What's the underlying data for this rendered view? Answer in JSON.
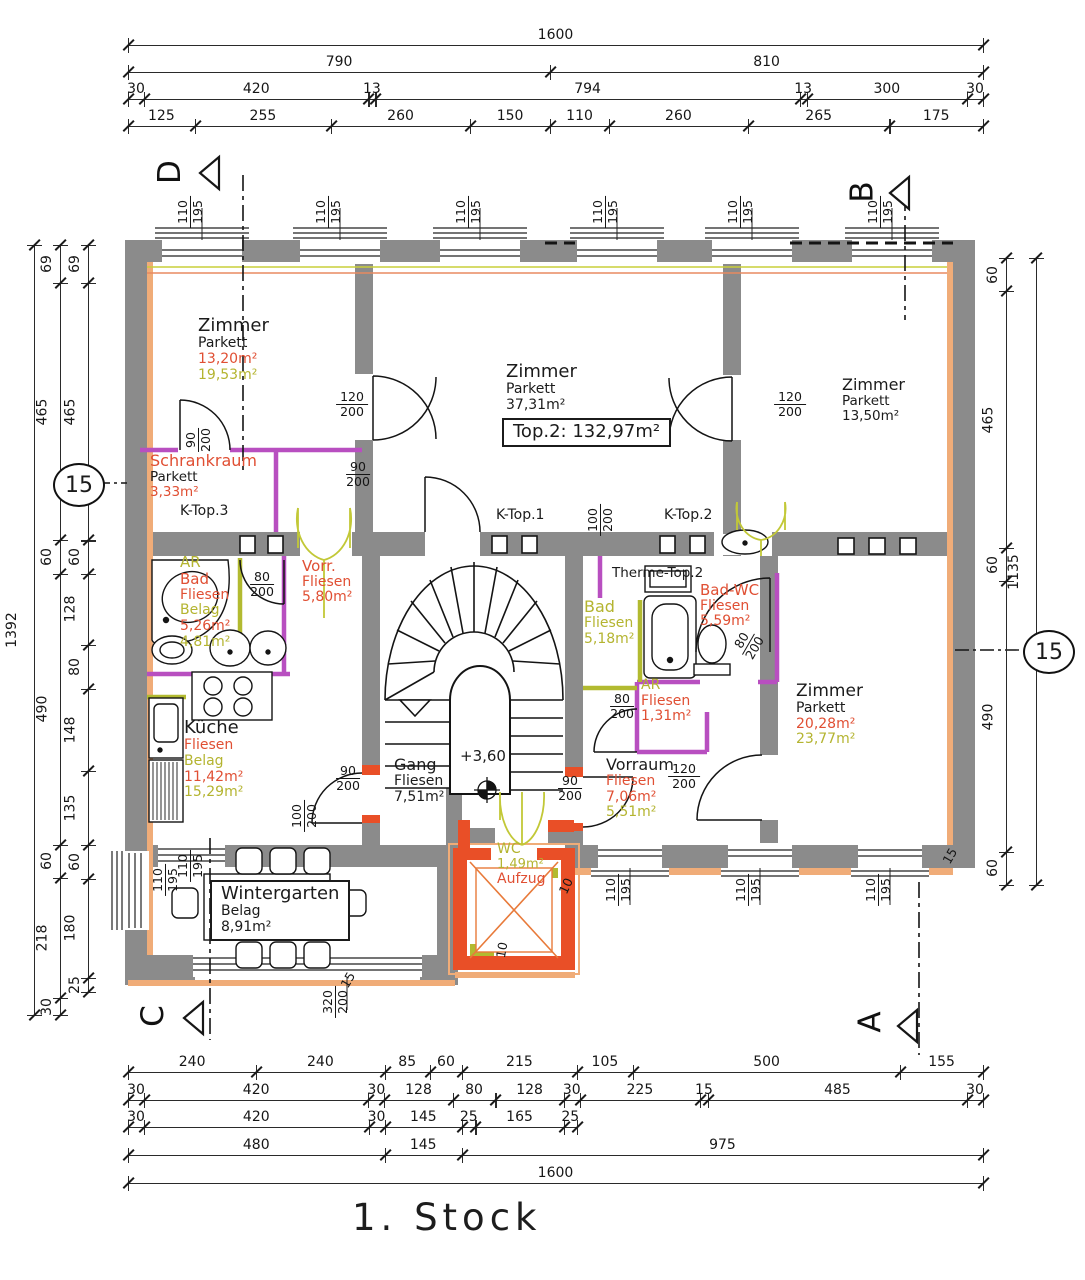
{
  "title": "1. Stock",
  "colors": {
    "k": "#1b1b1b",
    "r": "#e04f33",
    "y": "#b4b430",
    "wall": "#8b8b8b",
    "newwall": "#e94f27",
    "orange": "#f0ac78",
    "purple": "#b84fc0",
    "olive": "#b2ba30"
  },
  "rooms": [
    {
      "id": "zimmer-tl",
      "x": 198,
      "y": 316,
      "lines": [
        [
          "Zimmer",
          "k",
          18
        ],
        [
          "Parkett",
          "k",
          14
        ],
        [
          "13,20m²",
          "r",
          14
        ],
        [
          "19,53m²",
          "y",
          14
        ]
      ]
    },
    {
      "id": "schrankraum",
      "x": 150,
      "y": 452,
      "lines": [
        [
          "Schrankraum",
          "r",
          16
        ],
        [
          "Parkett",
          "k",
          13.5
        ],
        [
          "3,33m²",
          "r",
          13.5
        ]
      ]
    },
    {
      "id": "k-top-3",
      "x": 180,
      "y": 504,
      "lines": [
        [
          "K-Top.3",
          "k",
          14
        ]
      ]
    },
    {
      "id": "zimmer-mitte",
      "x": 506,
      "y": 362,
      "lines": [
        [
          "Zimmer",
          "k",
          18
        ],
        [
          "Parkett",
          "k",
          14
        ],
        [
          "37,31m²",
          "k",
          14
        ]
      ]
    },
    {
      "id": "top2-total",
      "x": 502,
      "y": 418,
      "box": true,
      "lines": [
        [
          "Top.2:  132,97m²",
          "k",
          18
        ]
      ]
    },
    {
      "id": "zimmer-tr",
      "x": 842,
      "y": 376,
      "lines": [
        [
          "Zimmer",
          "k",
          16
        ],
        [
          "Parkett",
          "k",
          13.5
        ],
        [
          "13,50m²",
          "k",
          13.5
        ]
      ]
    },
    {
      "id": "ar-bad",
      "x": 180,
      "y": 554,
      "lines": [
        [
          "AR",
          "y",
          15
        ],
        [
          "Bad",
          "r",
          15
        ],
        [
          "Fliesen",
          "r",
          14
        ],
        [
          "Belag",
          "y",
          14
        ],
        [
          "5,26m²",
          "r",
          14
        ],
        [
          "4,81m²",
          "y",
          14
        ]
      ]
    },
    {
      "id": "vorr",
      "x": 302,
      "y": 558,
      "lines": [
        [
          "Vorr.",
          "r",
          15
        ],
        [
          "Fliesen",
          "r",
          14
        ],
        [
          "5,80m²",
          "r",
          14
        ]
      ]
    },
    {
      "id": "kueche",
      "x": 184,
      "y": 718,
      "lines": [
        [
          "Küche",
          "k",
          18
        ],
        [
          "Fliesen",
          "r",
          14
        ],
        [
          "Belag",
          "y",
          14
        ],
        [
          "11,42m²",
          "r",
          14
        ],
        [
          "15,29m²",
          "y",
          14
        ]
      ]
    },
    {
      "id": "gang",
      "x": 394,
      "y": 756,
      "lines": [
        [
          "Gang",
          "k",
          16
        ],
        [
          "Fliesen",
          "k",
          14
        ],
        [
          "7,51m²",
          "k",
          14
        ]
      ]
    },
    {
      "id": "level",
      "x": 460,
      "y": 748,
      "lines": [
        [
          "+3,60",
          "k",
          15
        ]
      ]
    },
    {
      "id": "therme",
      "x": 612,
      "y": 566,
      "lines": [
        [
          "Therme-Top.2",
          "k",
          13.5
        ]
      ]
    },
    {
      "id": "bad-mitte",
      "x": 584,
      "y": 598,
      "lines": [
        [
          "Bad",
          "y",
          16
        ],
        [
          "Fliesen",
          "y",
          14
        ],
        [
          "5,18m²",
          "y",
          14
        ]
      ]
    },
    {
      "id": "bad-wc",
      "x": 700,
      "y": 582,
      "lines": [
        [
          "Bad-WC",
          "r",
          15
        ],
        [
          "Fliesen",
          "r",
          14
        ],
        [
          "5,59m²",
          "r",
          14
        ]
      ]
    },
    {
      "id": "ar-klein",
      "x": 641,
      "y": 678,
      "lines": [
        [
          "AR",
          "y",
          14
        ],
        [
          "Fliesen",
          "r",
          14
        ],
        [
          "1,31m²",
          "r",
          14
        ]
      ]
    },
    {
      "id": "vorraum",
      "x": 606,
      "y": 756,
      "lines": [
        [
          "Vorraum",
          "k",
          16
        ],
        [
          "Fliesen",
          "r",
          14
        ],
        [
          "7,06m²",
          "r",
          14
        ],
        [
          "5,51m²",
          "y",
          14
        ]
      ]
    },
    {
      "id": "zimmer-br",
      "x": 796,
      "y": 682,
      "lines": [
        [
          "Zimmer",
          "k",
          17
        ],
        [
          "Parkett",
          "k",
          14
        ],
        [
          "20,28m²",
          "r",
          14
        ],
        [
          "23,77m²",
          "y",
          14
        ]
      ]
    },
    {
      "id": "wintergarten",
      "x": 210,
      "y": 880,
      "box": true,
      "lines": [
        [
          "Wintergarten",
          "k",
          18
        ],
        [
          "Belag",
          "k",
          14
        ],
        [
          "8,91m²",
          "k",
          14
        ]
      ]
    },
    {
      "id": "wc-aufzug",
      "x": 497,
      "y": 842,
      "lines": [
        [
          "WC",
          "y",
          14
        ],
        [
          "1,49m²",
          "y",
          13
        ],
        [
          "Aufzug",
          "r",
          14
        ]
      ]
    },
    {
      "id": "k-top-1",
      "x": 496,
      "y": 508,
      "lines": [
        [
          "K-Top.1",
          "k",
          14
        ]
      ]
    },
    {
      "id": "k-top-2",
      "x": 664,
      "y": 508,
      "lines": [
        [
          "K-Top.2",
          "k",
          14
        ]
      ]
    }
  ],
  "frac_dims": [
    {
      "t": "110",
      "b": "195",
      "x": 190,
      "y": 212,
      "r": -90
    },
    {
      "t": "110",
      "b": "195",
      "x": 328,
      "y": 212,
      "r": -90
    },
    {
      "t": "110",
      "b": "195",
      "x": 468,
      "y": 212,
      "r": -90
    },
    {
      "t": "110",
      "b": "195",
      "x": 605,
      "y": 212,
      "r": -90
    },
    {
      "t": "110",
      "b": "195",
      "x": 740,
      "y": 212,
      "r": -90
    },
    {
      "t": "110",
      "b": "195",
      "x": 880,
      "y": 212,
      "r": -90
    },
    {
      "t": "110",
      "b": "195",
      "x": 165,
      "y": 880,
      "r": -90
    },
    {
      "t": "110",
      "b": "195",
      "x": 190,
      "y": 866,
      "r": -90
    },
    {
      "t": "110",
      "b": "195",
      "x": 618,
      "y": 890,
      "r": -90
    },
    {
      "t": "110",
      "b": "195",
      "x": 748,
      "y": 890,
      "r": -90
    },
    {
      "t": "110",
      "b": "195",
      "x": 878,
      "y": 890,
      "r": -90
    },
    {
      "t": "320",
      "b": "200",
      "x": 335,
      "y": 1002,
      "r": -90
    },
    {
      "t": "120",
      "b": "200",
      "x": 352,
      "y": 404,
      "r": 0
    },
    {
      "t": "90",
      "b": "200",
      "x": 358,
      "y": 474,
      "r": 0
    },
    {
      "t": "90",
      "b": "200",
      "x": 198,
      "y": 440,
      "r": -90
    },
    {
      "t": "120",
      "b": "200",
      "x": 790,
      "y": 404,
      "r": 0
    },
    {
      "t": "100",
      "b": "200",
      "x": 600,
      "y": 520,
      "r": -90
    },
    {
      "t": "80",
      "b": "200",
      "x": 262,
      "y": 584,
      "r": 0
    },
    {
      "t": "80",
      "b": "200",
      "x": 622,
      "y": 706,
      "r": 0
    },
    {
      "t": "80",
      "b": "200",
      "x": 748,
      "y": 644,
      "r": -60
    },
    {
      "t": "90",
      "b": "200",
      "x": 570,
      "y": 788,
      "r": 0
    },
    {
      "t": "120",
      "b": "200",
      "x": 684,
      "y": 776,
      "r": 0
    },
    {
      "t": "90",
      "b": "200",
      "x": 348,
      "y": 778,
      "r": 0
    },
    {
      "t": "100",
      "b": "200",
      "x": 304,
      "y": 816,
      "r": -90
    },
    {
      "t": "10",
      "b": null,
      "x": 566,
      "y": 886,
      "r": -65
    },
    {
      "t": "10",
      "b": null,
      "x": 502,
      "y": 950,
      "r": -80
    },
    {
      "t": "15",
      "b": null,
      "x": 950,
      "y": 856,
      "r": -60
    },
    {
      "t": "15",
      "b": null,
      "x": 348,
      "y": 980,
      "r": -60
    }
  ],
  "dim_chains": [
    {
      "id": "top-1",
      "d": "h",
      "x": 128,
      "y": 45,
      "l": 855,
      "s": [
        "1600"
      ]
    },
    {
      "id": "top-2",
      "d": "h",
      "x": 128,
      "y": 72,
      "l": 855,
      "s": [
        "790",
        "810"
      ]
    },
    {
      "id": "top-3",
      "d": "h",
      "x": 128,
      "y": 99,
      "l": 855,
      "s": [
        "30",
        "420",
        "13",
        "794",
        "13",
        "300",
        "30"
      ]
    },
    {
      "id": "top-4",
      "d": "h",
      "x": 128,
      "y": 126,
      "l": 855,
      "s": [
        "125",
        "255",
        "260",
        "150",
        "110",
        "260",
        "265",
        "175"
      ]
    },
    {
      "id": "bottom-1",
      "d": "h",
      "x": 128,
      "y": 1072,
      "l": 855,
      "s": [
        "240",
        "240",
        "85",
        "60",
        "215",
        "105",
        "500",
        "155"
      ]
    },
    {
      "id": "bottom-2",
      "d": "h",
      "x": 128,
      "y": 1100,
      "l": 855,
      "s": [
        "30",
        "420",
        "30",
        "128",
        "80",
        "128",
        "30",
        "225",
        "15",
        "485",
        "30"
      ]
    },
    {
      "id": "bottom-3",
      "d": "h",
      "x": 128,
      "y": 1127,
      "l": 449,
      "s": [
        "30",
        "420",
        "30",
        "145",
        "25",
        "165",
        "25"
      ]
    },
    {
      "id": "bottom-4",
      "d": "h",
      "x": 128,
      "y": 1155,
      "l": 855,
      "s": [
        "480",
        "145",
        "975"
      ]
    },
    {
      "id": "bottom-5",
      "d": "h",
      "x": 128,
      "y": 1183,
      "l": 855,
      "s": [
        "1600"
      ]
    },
    {
      "id": "left-1",
      "d": "v",
      "x": 34,
      "y": 245,
      "l": 770,
      "s": [
        "1392"
      ]
    },
    {
      "id": "left-2",
      "d": "v",
      "x": 60,
      "y": 245,
      "l": 770,
      "s": [
        "69",
        "465",
        "60",
        "490",
        "60",
        "218",
        "30"
      ]
    },
    {
      "id": "left-3",
      "d": "v",
      "x": 88,
      "y": 245,
      "l": 747,
      "s": [
        "69",
        "465",
        "60",
        "128",
        "80",
        "148",
        "135",
        "60",
        "180",
        "25"
      ]
    },
    {
      "id": "right-1",
      "d": "v",
      "x": 1006,
      "y": 258,
      "l": 627,
      "s": [
        "60",
        "465",
        "60",
        "490",
        "60"
      ]
    },
    {
      "id": "right-2",
      "d": "v",
      "x": 1036,
      "y": 258,
      "l": 627,
      "s": [
        "1135"
      ]
    }
  ],
  "markers": [
    {
      "letter": "D",
      "x": 158,
      "y": 154,
      "tx": 196,
      "ty": 153
    },
    {
      "letter": "B",
      "x": 852,
      "y": 174,
      "tx": 886,
      "ty": 173
    },
    {
      "letter": "C",
      "x": 142,
      "y": 998,
      "tx": 180,
      "ty": 998
    },
    {
      "letter": "A",
      "x": 860,
      "y": 1004,
      "tx": 894,
      "ty": 1006
    }
  ],
  "circles": [
    {
      "t": "15",
      "x": 53,
      "y": 463
    },
    {
      "t": "15",
      "x": 1023,
      "y": 630
    }
  ]
}
